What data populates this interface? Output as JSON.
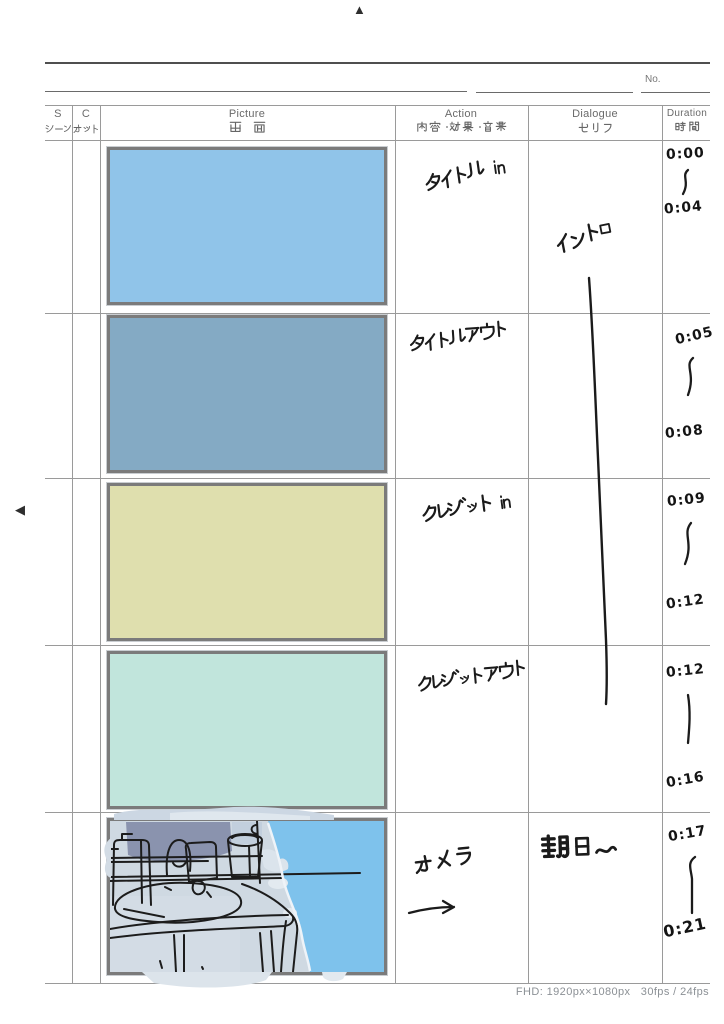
{
  "icons": {
    "top_marker": "▲",
    "side_marker": "◀"
  },
  "page": {
    "no_label": "No.",
    "footer": "FHD: 1920px×1080px   30fps / 24fps"
  },
  "header": {
    "columns": [
      {
        "en": "S",
        "ja": "シーン"
      },
      {
        "en": "C",
        "ja": "カット"
      },
      {
        "en": "Picture",
        "ja": "画 面"
      },
      {
        "en": "Action",
        "ja": "内容・効果・音楽"
      },
      {
        "en": "Dialogue",
        "ja": "セリフ"
      },
      {
        "en": "Duration",
        "ja": "時間"
      }
    ]
  },
  "rows": [
    {
      "picture": "light blue solid fill",
      "action": "タイトルin",
      "dialogue": "イントロ",
      "duration_start": "0:00",
      "duration_connector": "〜",
      "duration_end": "0:04"
    },
    {
      "picture": "slate blue solid fill",
      "action": "タイトルアウト",
      "dialogue": "",
      "duration_start": "0:05",
      "duration_connector": "〜",
      "duration_end": "0:08"
    },
    {
      "picture": "pale khaki solid fill",
      "action": "クレジットin",
      "dialogue": "",
      "duration_start": "0:09",
      "duration_connector": "〜",
      "duration_end": "0:12"
    },
    {
      "picture": "pale mint solid fill",
      "action": "クレジットアウト",
      "dialogue": "",
      "duration_start": "0:12",
      "duration_connector": "｜",
      "duration_end": "0:16"
    },
    {
      "picture": "rough sketch: bathroom sink counter with bottles and a cup, blue sky on the right",
      "action": "カメラ",
      "action_arrow": "→",
      "dialogue": "朝日〜",
      "duration_start": "0:17",
      "duration_connector": "〜",
      "duration_end": "0:21"
    }
  ],
  "overlay": {
    "dialogue_continuation_line": "handwritten stroke extending イントロ from cut 1 through cut 4"
  },
  "colors": {
    "frame_border": "#7b7b7b",
    "frame1": "#90c4e9",
    "frame2": "#84aac4",
    "frame3": "#dfdfae",
    "frame4": "#c1e5dc",
    "sketch_sky": "#7ec2ec",
    "sketch_wash": "#cfd9e2",
    "sketch_window": "#8a93ae",
    "grid_line": "#9a9a9a",
    "ink": "#1b1b1b",
    "print_text": "#6a6a6a"
  }
}
